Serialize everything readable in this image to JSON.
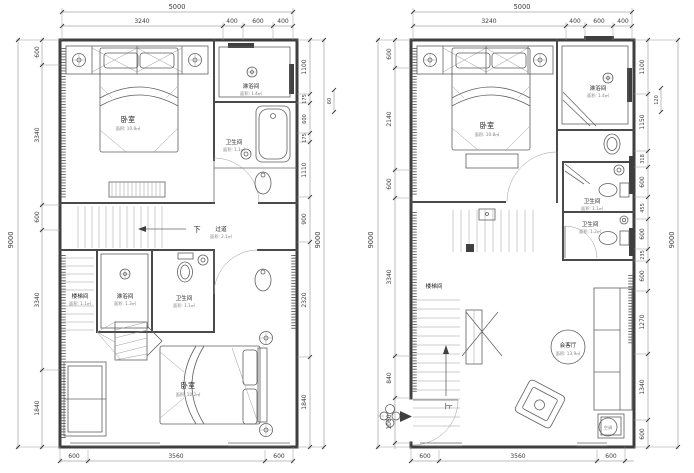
{
  "canvas": {
    "bg": "#ffffff",
    "wall_color": "#3f3f3f",
    "dim_color": "#3c3c3c"
  },
  "left_plan": {
    "dim_top_total": "5000",
    "dim_top": [
      "3240",
      "400",
      "600",
      "400"
    ],
    "dim_left_total": "9000",
    "dim_left": [
      "600",
      "3340",
      "600",
      "3340",
      "1840"
    ],
    "dim_right": [
      "1100",
      "175",
      "600",
      "175",
      "1110",
      "900",
      "2320",
      "1840"
    ],
    "dim_right_offset": "60",
    "dim_right_total": "9000",
    "dim_bottom": [
      "600",
      "3560",
      "600"
    ],
    "labels": {
      "bedroom_top": {
        "name": "卧室",
        "area": "面积: 10.8㎡"
      },
      "shower_top": {
        "name": "淋浴间",
        "area": "面积: 1.4㎡"
      },
      "toilet_top": {
        "name": "卫生间",
        "area": "面积: 1.1㎡"
      },
      "down": "下",
      "corridor": {
        "name": "过道",
        "area": "面积: 2.1㎡"
      },
      "stairwell": {
        "name": "楼梯间",
        "area": "面积: 1.1㎡"
      },
      "shower_mid": {
        "name": "淋浴间",
        "area": "面积: 1.3㎡"
      },
      "toilet_mid": {
        "name": "卫生间",
        "area": "面积: 1.1㎡"
      },
      "bedroom_bottom": {
        "name": "卧室",
        "area": "面积: 10.2㎡"
      }
    }
  },
  "right_plan": {
    "dim_top_total": "5000",
    "dim_top": [
      "3240",
      "400",
      "600",
      "400"
    ],
    "dim_left_total": "9000",
    "dim_left": [
      "600",
      "2140",
      "600",
      "3340",
      "840",
      "1060"
    ],
    "dim_right": [
      "1100",
      "1150",
      "318",
      "600",
      "455",
      "600",
      "235",
      "600",
      "1270",
      "1340",
      "600"
    ],
    "dim_right_offset": "120",
    "dim_right_total": "9000",
    "dim_bottom": [
      "600",
      "3560",
      "600"
    ],
    "labels": {
      "bedroom_top": {
        "name": "卧室",
        "area": "面积: 10.8㎡"
      },
      "shower_top": {
        "name": "淋浴间",
        "area": "面积: 1.4㎡"
      },
      "toilet_upper": {
        "name": "卫生间",
        "area": "面积: 1.1㎡"
      },
      "toilet_lower": {
        "name": "卫生间",
        "area": "面积: 1.2㎡"
      },
      "stairwell": {
        "name": "楼梯间"
      },
      "up": "上",
      "living": {
        "name": "会客厅",
        "area": "面积: 13.9㎡"
      },
      "ac": "空调"
    }
  }
}
